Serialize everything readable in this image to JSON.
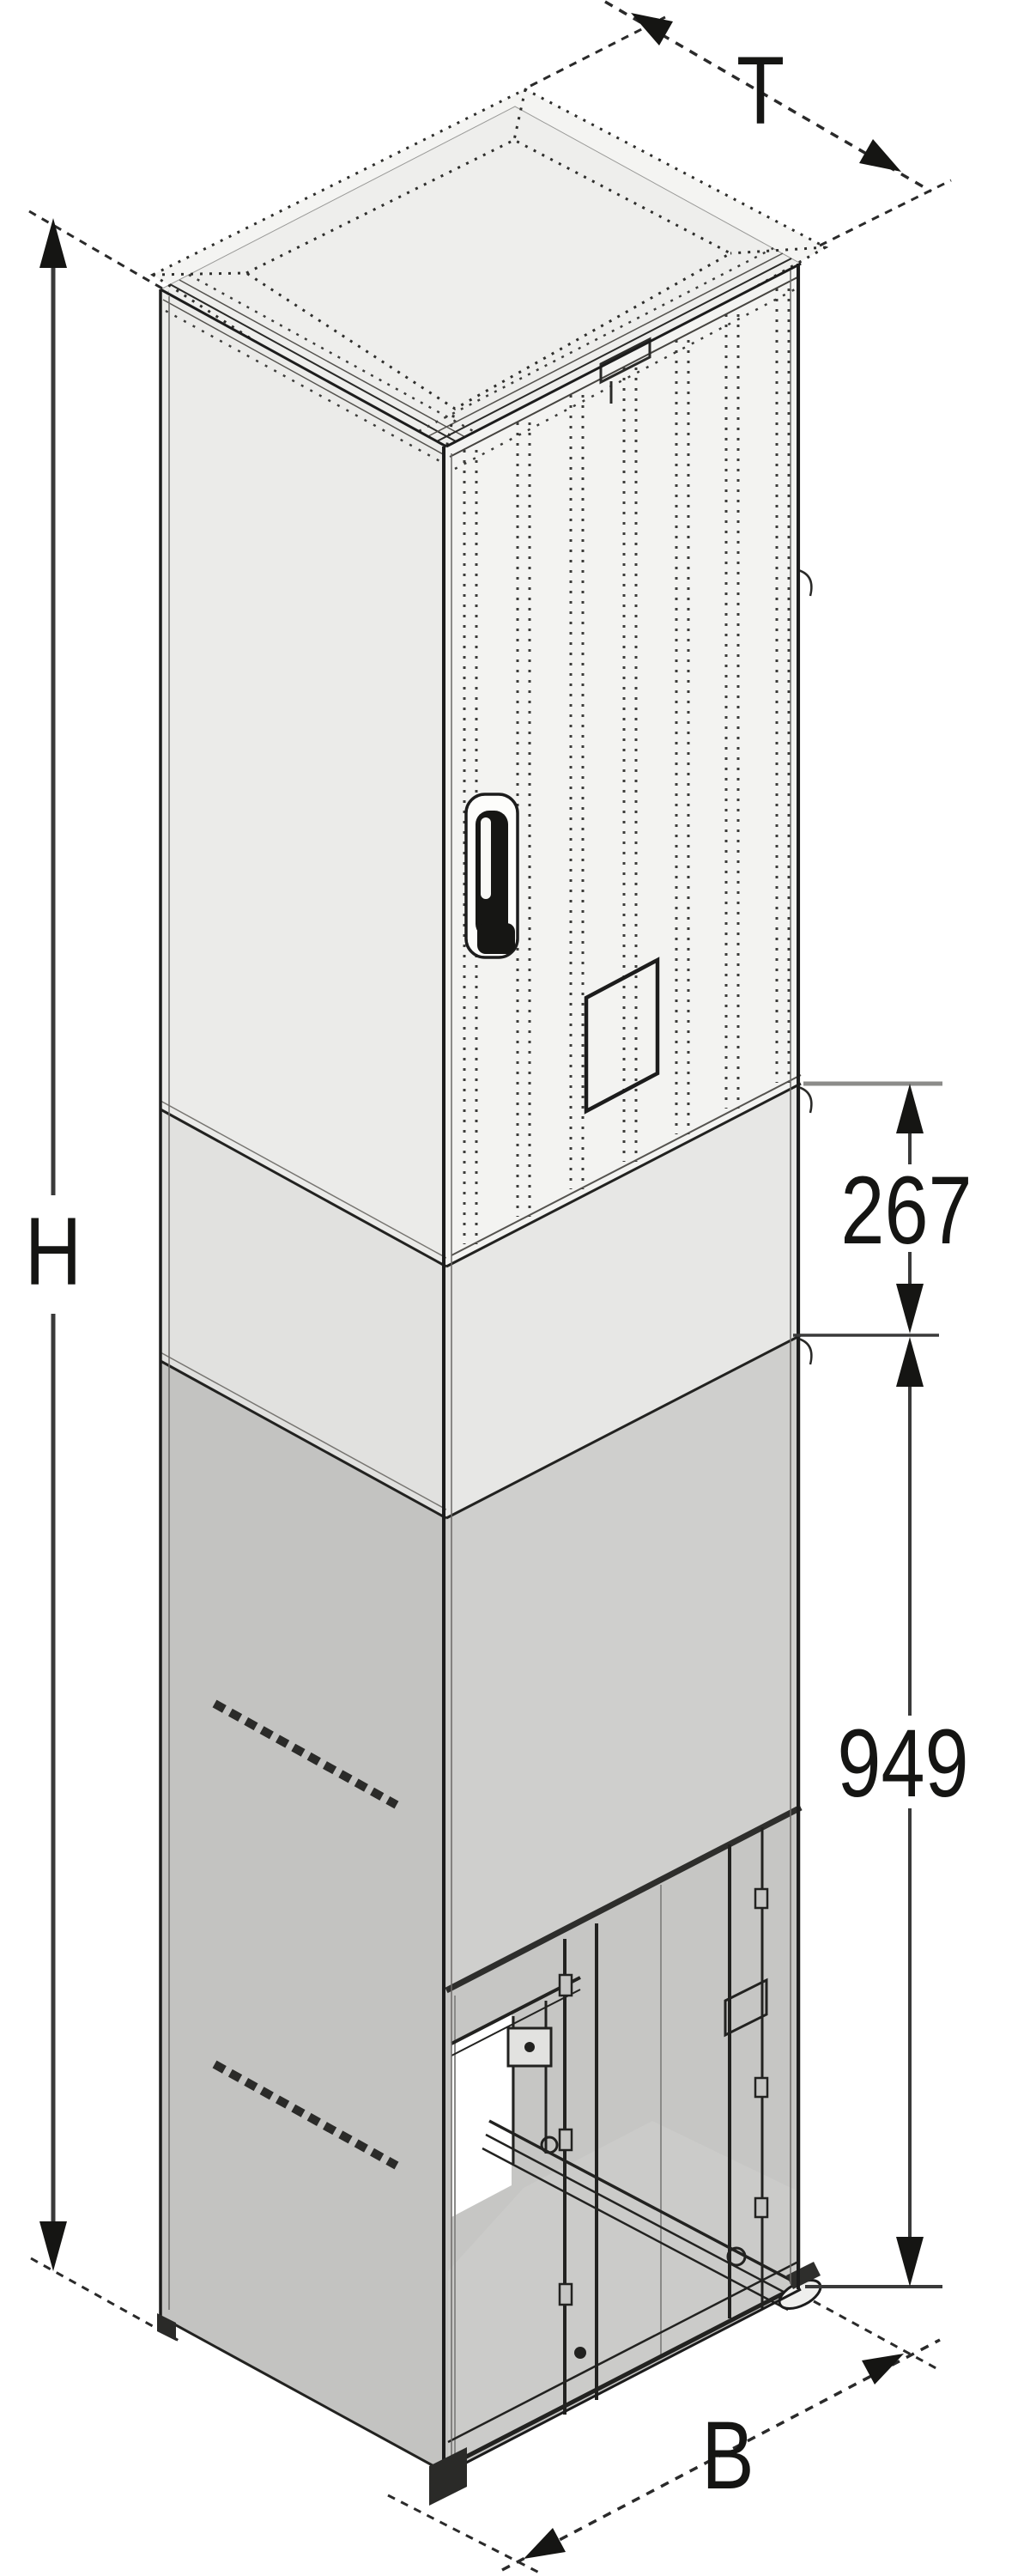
{
  "diagram": {
    "type": "isometric-technical-drawing",
    "subject": "Floor-standing electronics cabinet / outdoor enclosure with roof cap, perforated door and open plinth base",
    "labels": {
      "depth": "T",
      "height": "H",
      "width": "B",
      "plinth_upper_mm": "267",
      "plinth_lower_mm": "949"
    },
    "colors": {
      "background": "#ffffff",
      "line": "#1c1c1c",
      "dimension_line": "#3a3a3a",
      "roof_face": "#f4f4f2",
      "top_face": "#eeeeec",
      "front_upper": "#f3f3f1",
      "side_upper": "#ebebe9",
      "front_mid": "#e7e7e5",
      "side_mid": "#e1e1df",
      "front_lower": "#cfcfcd",
      "side_lower": "#c3c3c1",
      "interior": "#c6c6c4"
    }
  }
}
